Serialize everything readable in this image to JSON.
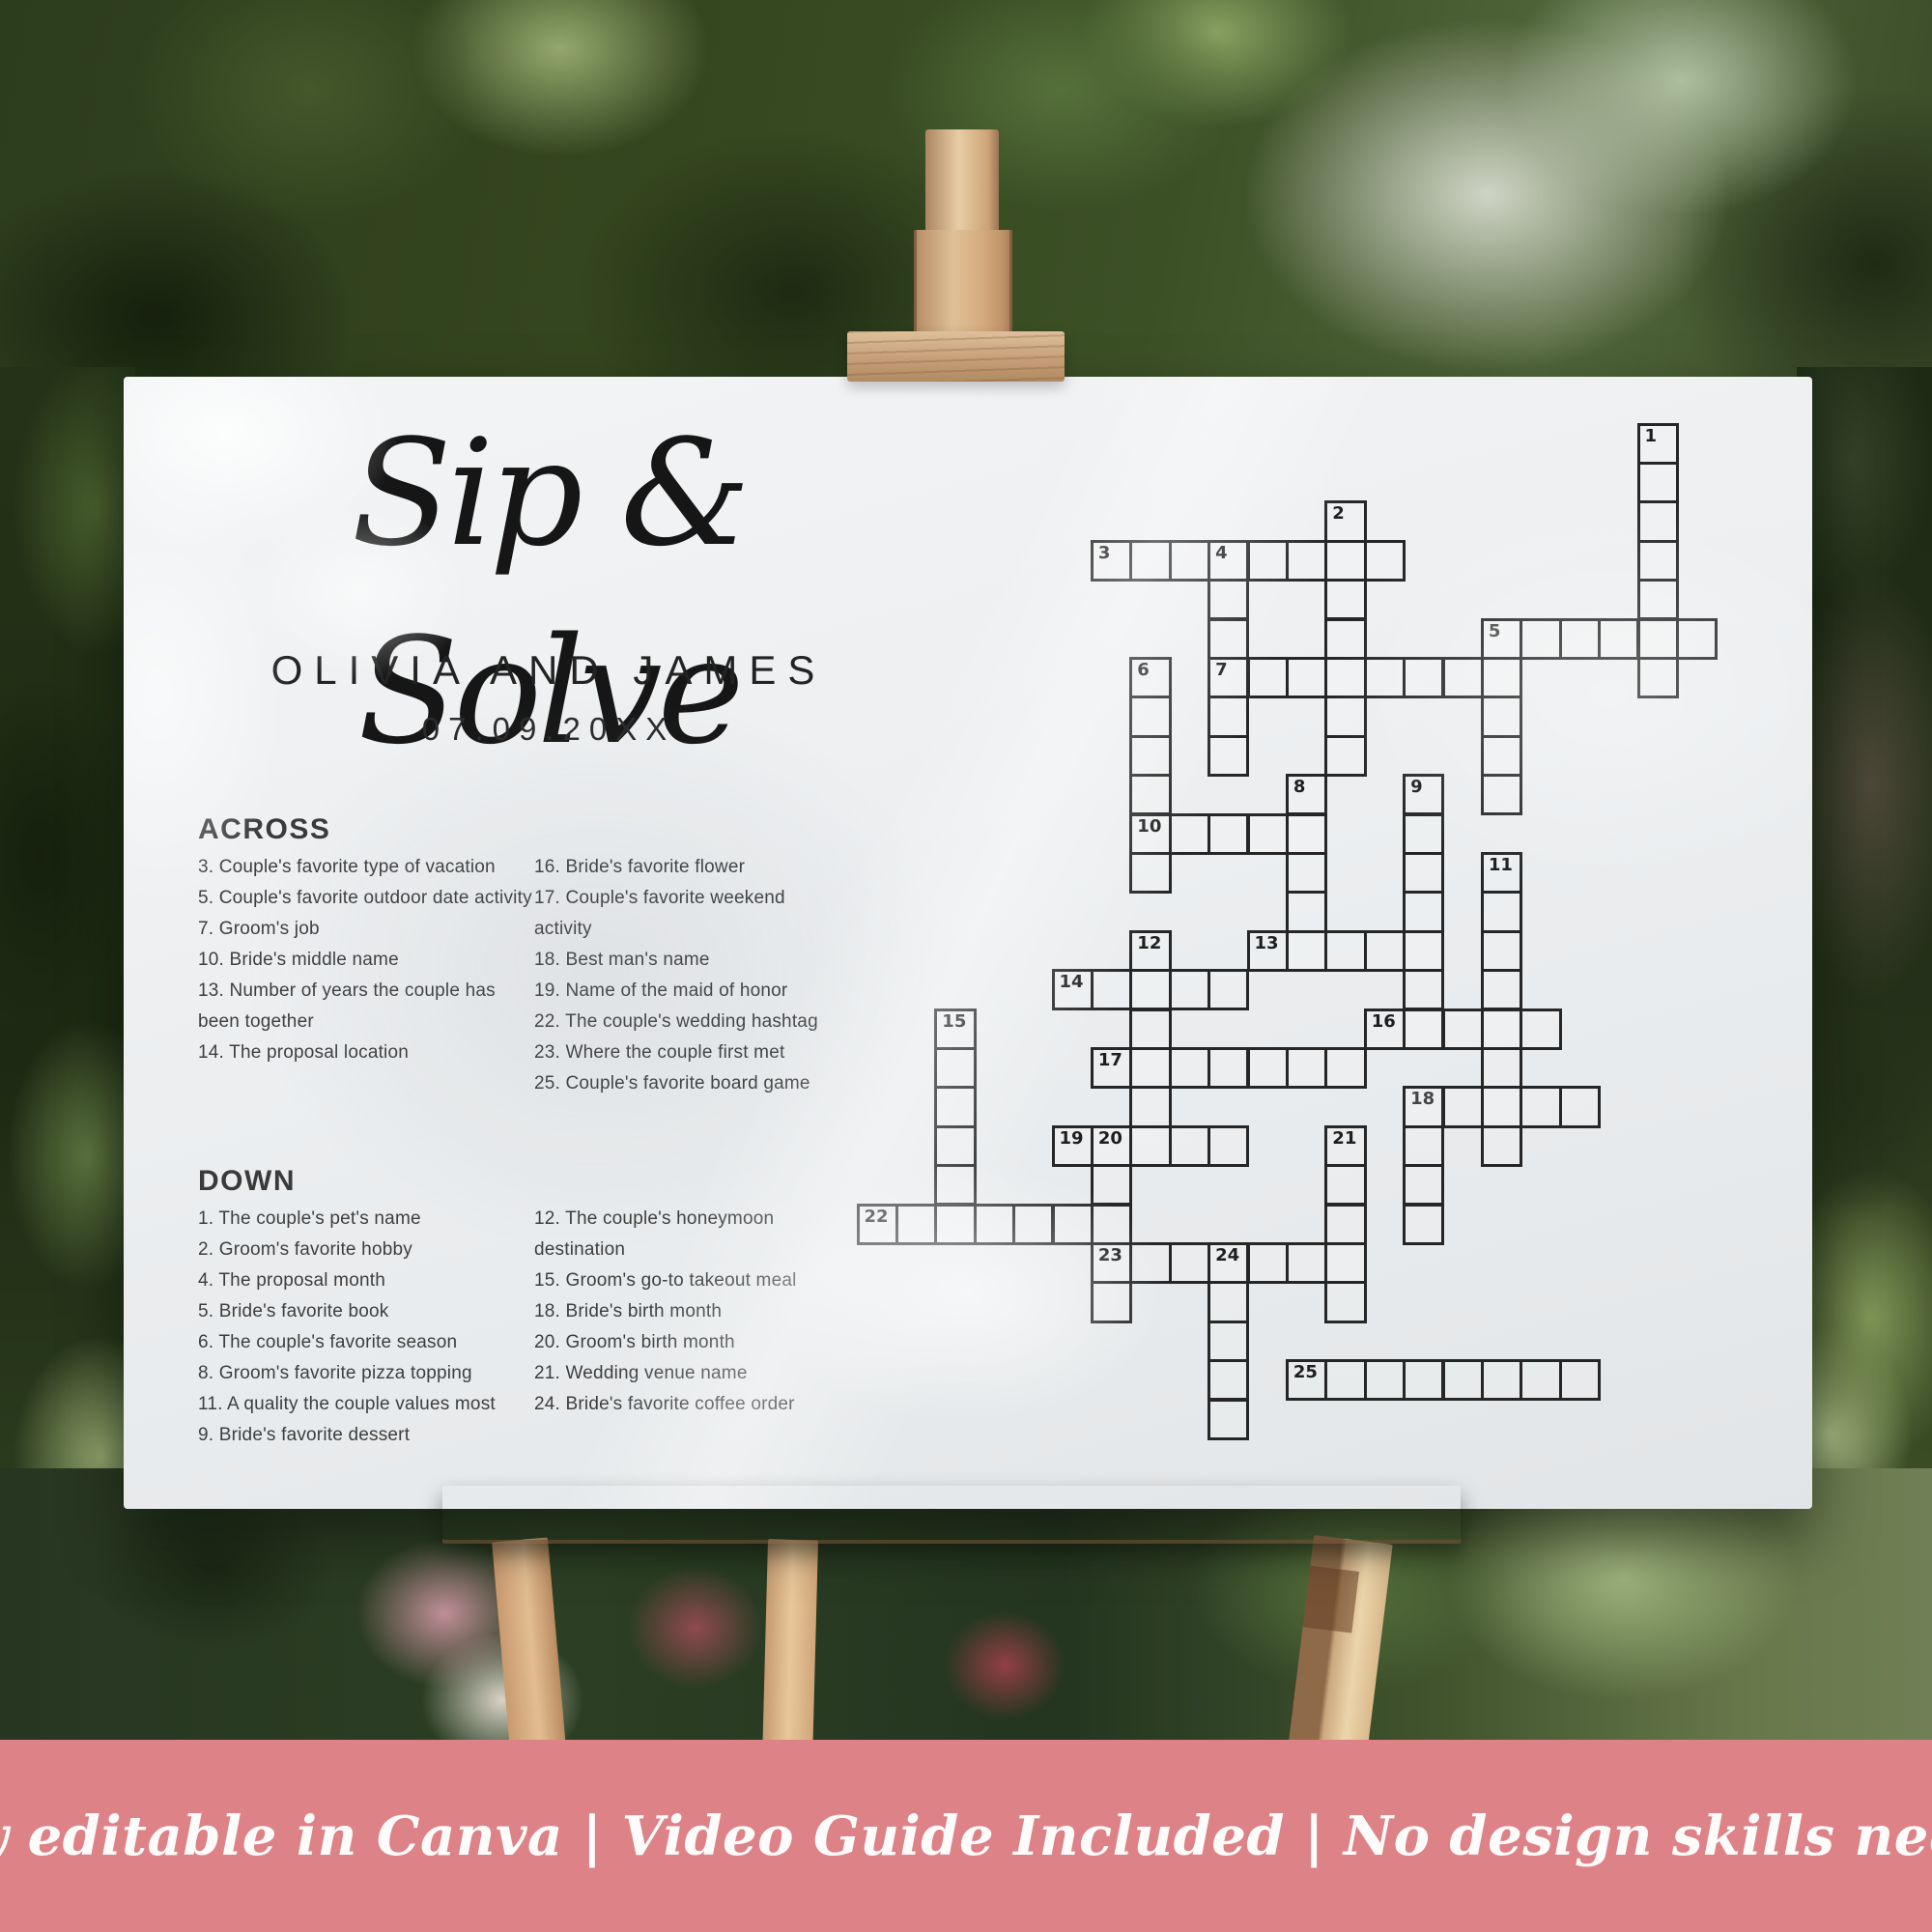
{
  "poster": {
    "title": "Sip & Solve",
    "couple_names": "OLIVIA AND JAMES",
    "wedding_date": "07.09.20XX",
    "background": "#edeff1",
    "across": {
      "header": "ACROSS",
      "col1": [
        "3. Couple's favorite type of vacation",
        "5. Couple's favorite outdoor date activity",
        "7. Groom's job",
        "10. Bride's middle name",
        "13. Number of years the couple has been together",
        "14. The proposal location"
      ],
      "col2": [
        "16. Bride's favorite flower",
        "17. Couple's favorite weekend activity",
        "18. Best man's name",
        "19. Name of the maid of honor",
        "22. The couple's wedding hashtag",
        "23. Where the couple first met",
        "25. Couple's favorite board game"
      ]
    },
    "down": {
      "header": "DOWN",
      "col1": [
        "1. The couple's pet's name",
        "2. Groom's favorite hobby",
        "4. The proposal month",
        "5. Bride's favorite book",
        "6. The couple's favorite season",
        "8. Groom's favorite pizza topping",
        "11. A quality the couple values most",
        "9. Bride's favorite dessert"
      ],
      "col2": [
        "12. The couple's honeymoon destination",
        "15. Groom's go-to takeout meal",
        "18. Bride's birth month",
        "20. Groom's birth month",
        "21. Wedding venue name",
        "24. Bride's favorite coffee order"
      ]
    }
  },
  "crossword": {
    "cell_size": 40.4,
    "line_color": "#262626",
    "words": [
      {
        "n": "1",
        "dir": "down",
        "col": 20,
        "row": 0,
        "len": 7
      },
      {
        "n": "2",
        "dir": "down",
        "col": 12,
        "row": 2,
        "len": 7
      },
      {
        "n": "3",
        "dir": "across",
        "col": 6,
        "row": 3,
        "len": 8
      },
      {
        "n": "4",
        "dir": "down",
        "col": 9,
        "row": 3,
        "len": 6
      },
      {
        "n": "5",
        "dir": "across",
        "col": 16,
        "row": 5,
        "len": 6
      },
      {
        "n": "5",
        "dir": "down",
        "col": 16,
        "row": 5,
        "len": 5,
        "dup": true
      },
      {
        "n": "6",
        "dir": "down",
        "col": 7,
        "row": 6,
        "len": 6
      },
      {
        "n": "7",
        "dir": "across",
        "col": 9,
        "row": 6,
        "len": 8
      },
      {
        "n": "8",
        "dir": "down",
        "col": 11,
        "row": 9,
        "len": 5
      },
      {
        "n": "9",
        "dir": "down",
        "col": 14,
        "row": 9,
        "len": 7
      },
      {
        "n": "10",
        "dir": "across",
        "col": 7,
        "row": 10,
        "len": 5
      },
      {
        "n": "11",
        "dir": "down",
        "col": 16,
        "row": 11,
        "len": 8
      },
      {
        "n": "12",
        "dir": "down",
        "col": 7,
        "row": 13,
        "len": 6
      },
      {
        "n": "13",
        "dir": "across",
        "col": 10,
        "row": 13,
        "len": 5
      },
      {
        "n": "14",
        "dir": "across",
        "col": 5,
        "row": 14,
        "len": 5
      },
      {
        "n": "15",
        "dir": "down",
        "col": 2,
        "row": 15,
        "len": 6
      },
      {
        "n": "16",
        "dir": "across",
        "col": 13,
        "row": 15,
        "len": 5
      },
      {
        "n": "17",
        "dir": "across",
        "col": 6,
        "row": 16,
        "len": 7
      },
      {
        "n": "18",
        "dir": "across",
        "col": 14,
        "row": 17,
        "len": 5
      },
      {
        "n": "18",
        "dir": "down",
        "col": 14,
        "row": 17,
        "len": 4,
        "dup": true
      },
      {
        "n": "19",
        "dir": "across",
        "col": 5,
        "row": 18,
        "len": 5
      },
      {
        "n": "20",
        "dir": "down",
        "col": 6,
        "row": 18,
        "len": 5
      },
      {
        "n": "21",
        "dir": "down",
        "col": 12,
        "row": 18,
        "len": 5
      },
      {
        "n": "22",
        "dir": "across",
        "col": 0,
        "row": 20,
        "len": 6
      },
      {
        "n": "23",
        "dir": "across",
        "col": 6,
        "row": 21,
        "len": 7
      },
      {
        "n": "24",
        "dir": "down",
        "col": 9,
        "row": 21,
        "len": 5
      },
      {
        "n": "25",
        "dir": "across",
        "col": 11,
        "row": 24,
        "len": 8
      }
    ]
  },
  "banner": {
    "text": "Fully editable in Canva | Video Guide Included | No design skills needed",
    "background": "#dd8287",
    "text_color": "#fefcfb"
  }
}
